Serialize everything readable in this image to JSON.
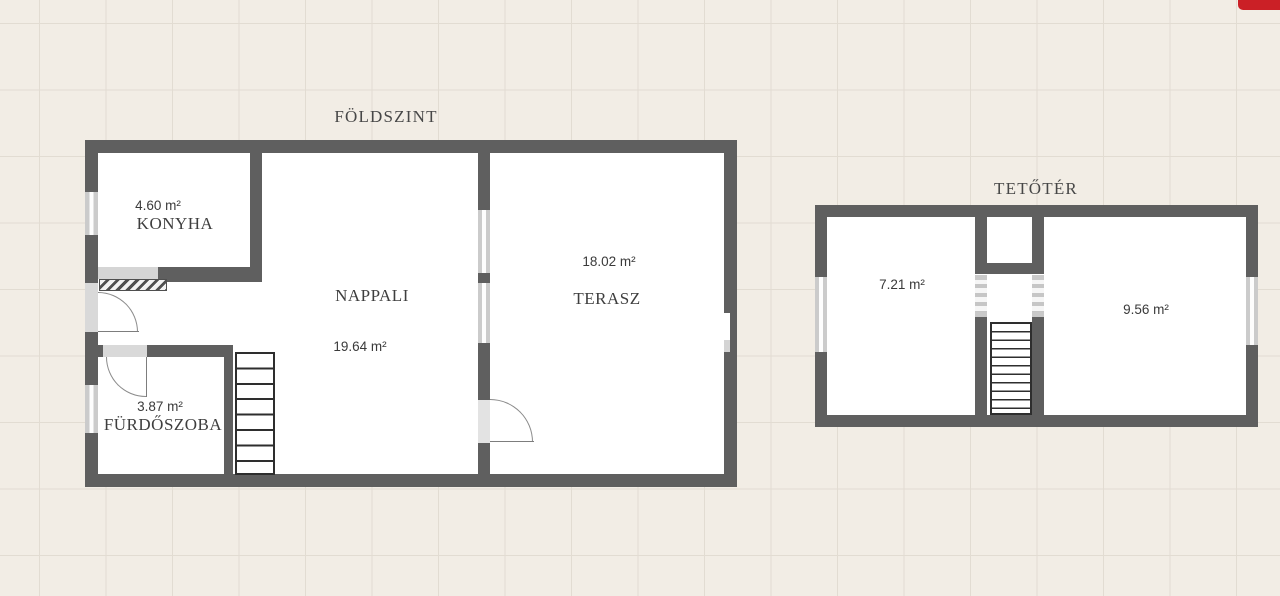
{
  "canvas": {
    "background": "#f2ede5",
    "grid_line_color": "#e2dcd2",
    "wall_color": "#5f5f5f",
    "window_color": "#cbcbcb",
    "red_button_color": "#cb2026"
  },
  "ground_floor": {
    "title": "FÖLDSZINT",
    "rooms": {
      "konyha": {
        "name": "KONYHA",
        "area": "4.60 m²"
      },
      "nappali": {
        "name": "NAPPALI",
        "area": "19.64 m²"
      },
      "terasz": {
        "name": "TERASZ",
        "area": "18.02 m²"
      },
      "furdoszoba": {
        "name": "FÜRDŐSZOBA",
        "area": "3.87 m²"
      }
    }
  },
  "attic": {
    "title": "TETŐTÉR",
    "rooms": {
      "room_left": {
        "area": "7.21 m²"
      },
      "room_right": {
        "area": "9.56 m²"
      }
    }
  }
}
